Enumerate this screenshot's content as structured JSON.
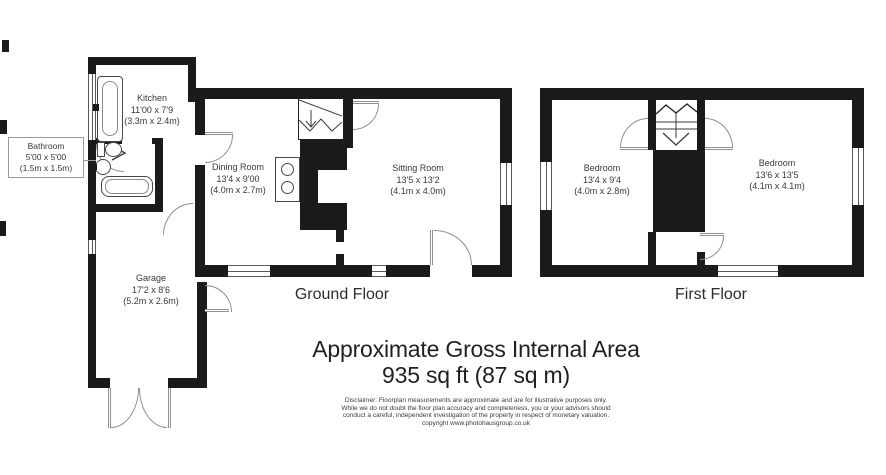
{
  "title": {
    "line1": "Approximate Gross Internal Area",
    "line2": "935 sq ft (87 sq m)"
  },
  "floors": {
    "ground": "Ground Floor",
    "first": "First Floor"
  },
  "rooms": {
    "kitchen": {
      "name": "Kitchen",
      "imperial": "11'00 x 7'9",
      "metric": "(3.3m x 2.4m)"
    },
    "bathroom": {
      "name": "Bathroom",
      "imperial": "5'00 x 5'00",
      "metric": "(1.5m x 1.5m)"
    },
    "dining": {
      "name": "Dining Room",
      "imperial": "13'4 x 9'00",
      "metric": "(4.0m x 2.7m)"
    },
    "sitting": {
      "name": "Sitting Room",
      "imperial": "13'5 x 13'2",
      "metric": "(4.1m x 4.0m)"
    },
    "garage": {
      "name": "Garage",
      "imperial": "17'2 x 8'6",
      "metric": "(5.2m x 2.6m)"
    },
    "bedroom1": {
      "name": "Bedroom",
      "imperial": "13'4 x 9'4",
      "metric": "(4.0m x 2.8m)"
    },
    "bedroom2": {
      "name": "Bedroom",
      "imperial": "13'6 x 13'5",
      "metric": "(4.1m x 4.1m)"
    }
  },
  "disclaimer": {
    "line1": "Disclaimer: Floorplan measurements are approximate and are for illustrative purposes only.",
    "line2": "While we do not doubt the floor plan accuracy and completeness, you or your advisors should",
    "line3": "conduct a careful, independent investigation of the property in respect of monetary valuation.",
    "line4": "copyright www.photohausgroup.co.uk"
  },
  "colors": {
    "wall": "#1b1b1b",
    "door_line": "#8f8f8f",
    "window_line": "#5a5a5a",
    "text": "#3b3738",
    "background": "#ffffff"
  }
}
